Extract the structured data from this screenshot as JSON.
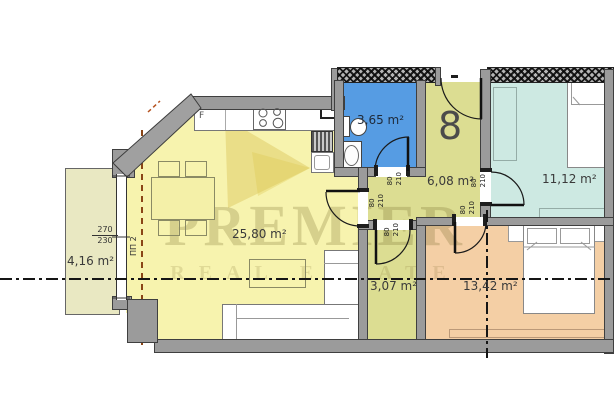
{
  "unit": {
    "number": "8"
  },
  "watermark": {
    "brand": "PREMIER",
    "tagline": "REAL ESTATE"
  },
  "rooms": {
    "living": {
      "area": "25,80 m²"
    },
    "balcony": {
      "area": "4,16 m²"
    },
    "bathroom": {
      "area": "3,65 m²"
    },
    "hallway": {
      "area": "6,08 m²"
    },
    "bedroom_small": {
      "area": "11,12 m²"
    },
    "bedroom_large": {
      "area": "13,42 m²"
    },
    "storage": {
      "area": "3,07 m²"
    }
  },
  "kitchen": {
    "fridge_label": "F"
  },
  "window_schedule": {
    "width": "270",
    "height": "230",
    "code": "ПП 2"
  },
  "door_schedule": {
    "width": "80",
    "height": "210"
  },
  "colors": {
    "living": "#f7f3ae",
    "balcony": "#e9e8c2",
    "bathroom": "#569ce3",
    "hallway": "#dcdd92",
    "bedroom_small": "#cde9e2",
    "bedroom_large": "#f4cfa5",
    "storage": "#dcdd92",
    "wall": "#9b9b9b"
  }
}
